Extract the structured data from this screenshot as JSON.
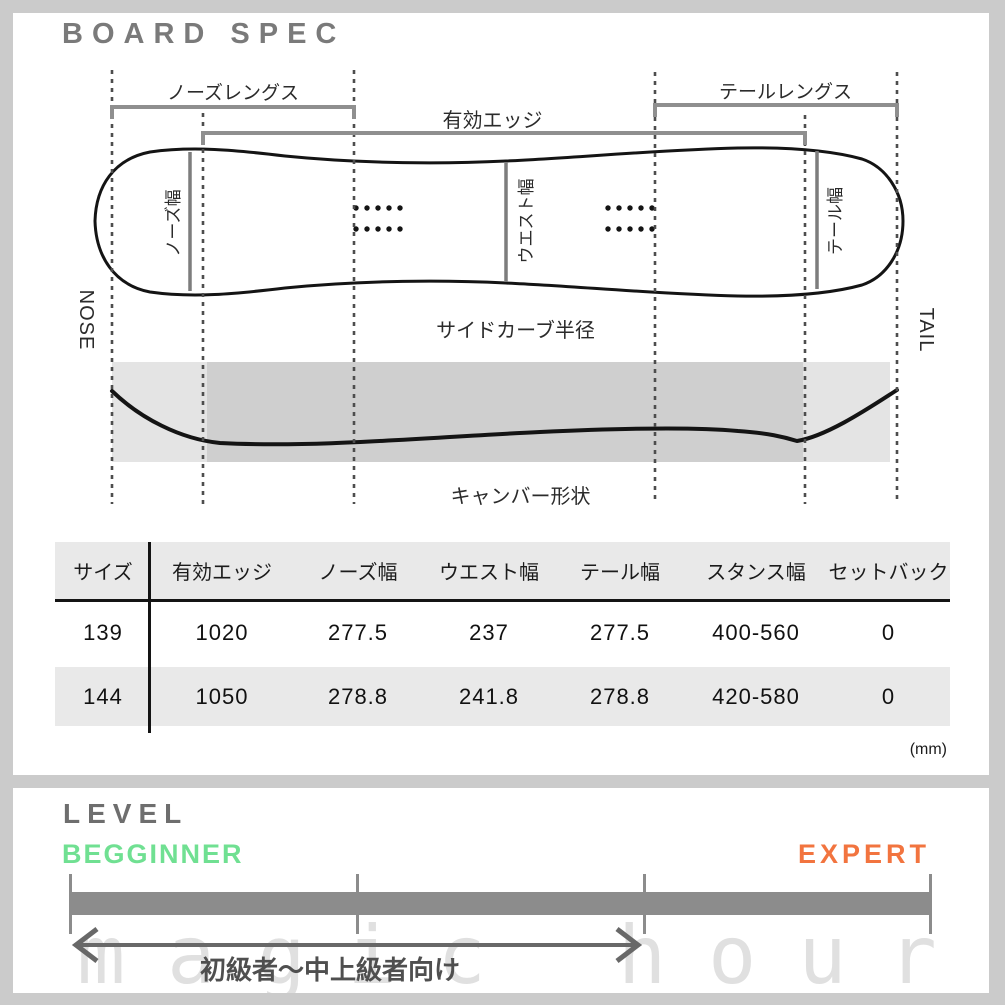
{
  "board_spec": {
    "title": "BOARD SPEC",
    "diagram": {
      "nose_length_label": "ノーズレングス",
      "effective_edge_label": "有効エッジ",
      "tail_length_label": "テールレングス",
      "nose_width_label": "ノーズ幅",
      "waist_width_label": "ウエスト幅",
      "tail_width_label": "テール幅",
      "nose_label": "NOSE",
      "tail_label": "TAIL",
      "sidecut_label": "サイドカーブ半径",
      "camber_label": "キャンバー形状"
    },
    "table": {
      "headers": [
        "サイズ",
        "有効エッジ",
        "ノーズ幅",
        "ウエスト幅",
        "テール幅",
        "スタンス幅",
        "セットバック"
      ],
      "rows": [
        [
          "139",
          "1020",
          "277.5",
          "237",
          "277.5",
          "400-560",
          "0"
        ],
        [
          "144",
          "1050",
          "278.8",
          "241.8",
          "278.8",
          "420-580",
          "0"
        ]
      ],
      "unit_note": "(mm)"
    }
  },
  "level": {
    "title": "LEVEL",
    "beginner_label": "BEGGINNER",
    "expert_label": "EXPERT",
    "range_label": "初級者～中上級者向け",
    "beginner_color": "#70e092",
    "expert_color": "#f2743f",
    "bar_color": "#8c8c8c"
  },
  "watermark_text": "magic hour"
}
